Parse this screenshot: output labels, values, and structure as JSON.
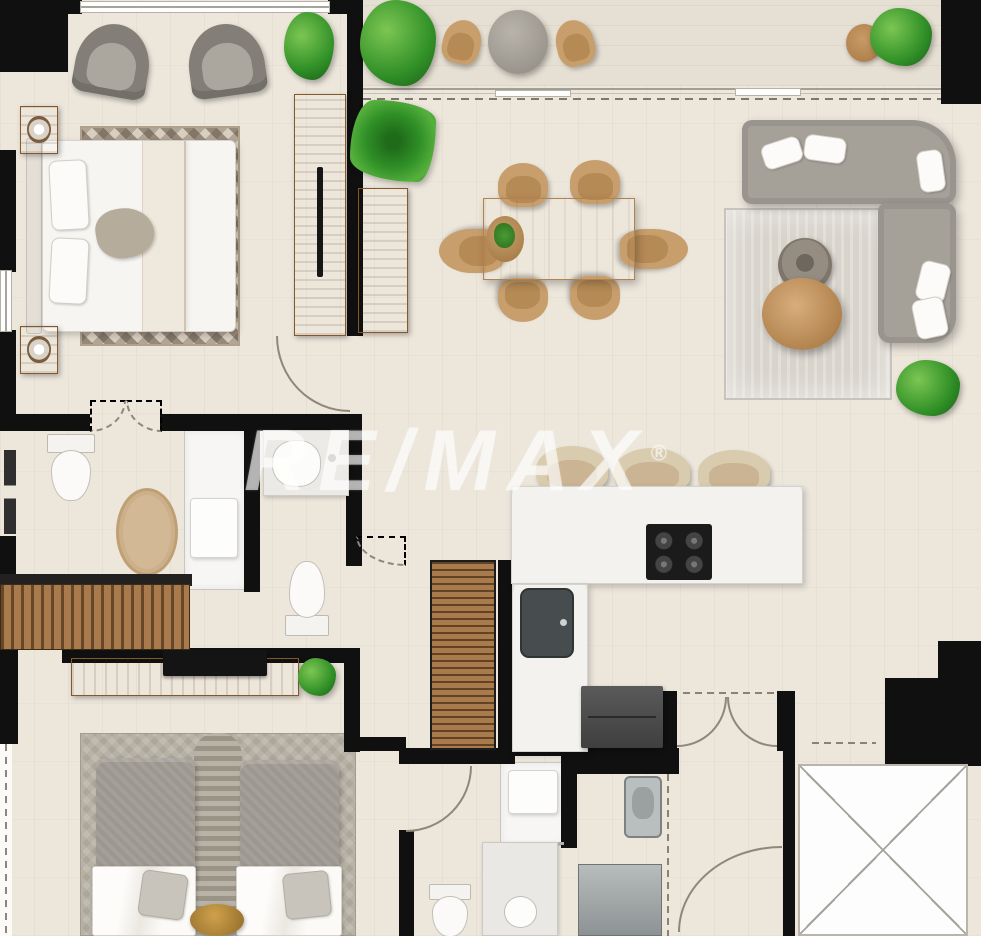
{
  "watermark": {
    "text": "RE/MAX",
    "registered": "®"
  },
  "colors": {
    "wall": "#101010",
    "floor": "#ece6db",
    "floor_balcony": "#e6dfd3",
    "wood": "#b5824f",
    "sofa": "#a5a199",
    "rug_living": "#d8d4cc",
    "rug_bed2": "#b7b1a4",
    "counter": "#f3f2ef",
    "plant": "#2f8f26",
    "gold": "#cfa14c"
  },
  "elements": [
    {
      "n": "floor-main",
      "t": "floor",
      "x": 0,
      "y": 0,
      "w": 981,
      "h": 936
    },
    {
      "n": "floor-balcony",
      "t": "floor-balcony",
      "x": 363,
      "y": 0,
      "w": 578,
      "h": 86
    },
    {
      "n": "shower-floor-master",
      "t": "shower-floor",
      "x": 184,
      "y": 430,
      "w": 62,
      "h": 160
    },
    {
      "n": "shower-floor-second",
      "t": "shower-floor",
      "x": 500,
      "y": 762,
      "w": 66,
      "h": 84
    },
    {
      "n": "rug-master-bedroom",
      "t": "rug-zigzag",
      "x": 80,
      "y": 126,
      "w": 160,
      "h": 220
    },
    {
      "n": "rug-living-room",
      "t": "rug-living",
      "x": 724,
      "y": 208,
      "w": 168,
      "h": 192
    },
    {
      "n": "rug-second-bedroom",
      "t": "rug-bed2",
      "x": 80,
      "y": 733,
      "w": 276,
      "h": 203
    },
    {
      "n": "rug-runner-second-bedroom",
      "t": "runner",
      "x": 194,
      "y": 733,
      "w": 48,
      "h": 203
    },
    {
      "n": "rug-oval-bathroom",
      "t": "rug-oval",
      "x": 116,
      "y": 488,
      "w": 62,
      "h": 88
    },
    {
      "n": "wall-corner-top-left",
      "t": "wall",
      "x": 0,
      "y": 0,
      "w": 68,
      "h": 72
    },
    {
      "n": "wall-top-a",
      "t": "wall",
      "x": 62,
      "y": 0,
      "w": 20,
      "h": 14
    },
    {
      "n": "wall-top-b",
      "t": "wall",
      "x": 328,
      "y": 0,
      "w": 35,
      "h": 14
    },
    {
      "n": "wall-bedroom-right",
      "t": "wall",
      "x": 347,
      "y": 0,
      "w": 16,
      "h": 336
    },
    {
      "n": "wall-corner-top-right",
      "t": "wall",
      "x": 941,
      "y": 0,
      "w": 40,
      "h": 104
    },
    {
      "n": "wall-left-upper",
      "t": "wall",
      "x": 0,
      "y": 150,
      "w": 16,
      "h": 122
    },
    {
      "n": "wall-left-mid",
      "t": "wall",
      "x": 0,
      "y": 330,
      "w": 16,
      "h": 88
    },
    {
      "n": "wall-bathroom-top-a",
      "t": "wall",
      "x": 0,
      "y": 414,
      "w": 90,
      "h": 17
    },
    {
      "n": "wall-bathroom-top-b",
      "t": "wall",
      "x": 160,
      "y": 414,
      "w": 202,
      "h": 17
    },
    {
      "n": "wall-mid-vertical",
      "t": "wall",
      "x": 346,
      "y": 414,
      "w": 16,
      "h": 152
    },
    {
      "n": "wall-bathroom-divider",
      "t": "wall",
      "x": 244,
      "y": 428,
      "w": 16,
      "h": 164
    },
    {
      "n": "wall-left-lower",
      "t": "wall",
      "x": 0,
      "y": 536,
      "w": 16,
      "h": 50
    },
    {
      "n": "wall-closet-frame",
      "t": "wall-dark",
      "x": 0,
      "y": 574,
      "w": 192,
      "h": 12
    },
    {
      "n": "wall-bedroom2-top",
      "t": "wall",
      "x": 62,
      "y": 648,
      "w": 296,
      "h": 15
    },
    {
      "n": "wall-hall-vertical",
      "t": "wall",
      "x": 344,
      "y": 648,
      "w": 16,
      "h": 104
    },
    {
      "n": "wall-bath2-top-a",
      "t": "wall",
      "x": 344,
      "y": 737,
      "w": 62,
      "h": 14
    },
    {
      "n": "wall-bath2-top-b",
      "t": "wall",
      "x": 399,
      "y": 748,
      "w": 116,
      "h": 16
    },
    {
      "n": "wall-bath2-left",
      "t": "wall",
      "x": 399,
      "y": 830,
      "w": 15,
      "h": 106
    },
    {
      "n": "wall-bath2-right",
      "t": "wall",
      "x": 561,
      "y": 746,
      "w": 16,
      "h": 102
    },
    {
      "n": "wall-pantry-right",
      "t": "wall",
      "x": 498,
      "y": 560,
      "w": 14,
      "h": 192
    },
    {
      "n": "wall-under-counter",
      "t": "wall",
      "x": 498,
      "y": 740,
      "w": 80,
      "h": 16
    },
    {
      "n": "wall-utility-top",
      "t": "wall",
      "x": 575,
      "y": 748,
      "w": 104,
      "h": 26
    },
    {
      "n": "wall-entry-left",
      "t": "wall",
      "x": 661,
      "y": 691,
      "w": 16,
      "h": 60
    },
    {
      "n": "wall-entry-right",
      "t": "wall",
      "x": 777,
      "y": 691,
      "w": 18,
      "h": 60
    },
    {
      "n": "wall-hallway-left",
      "t": "wall",
      "x": 783,
      "y": 691,
      "w": 12,
      "h": 245
    },
    {
      "n": "wall-elevator-block",
      "t": "wall",
      "x": 885,
      "y": 678,
      "w": 96,
      "h": 88
    },
    {
      "n": "wall-corner-right",
      "t": "wall",
      "x": 938,
      "y": 641,
      "w": 43,
      "h": 42
    },
    {
      "n": "wall-bedroom2-left",
      "t": "wall",
      "x": 0,
      "y": 648,
      "w": 18,
      "h": 96
    },
    {
      "n": "window-bedroom-top",
      "t": "window-h",
      "x": 80,
      "y": 1,
      "w": 250,
      "h": 12
    },
    {
      "n": "window-left-upper",
      "t": "window-v",
      "x": 0,
      "y": 270,
      "w": 12,
      "h": 62
    },
    {
      "n": "window-bedroom2-left",
      "t": "window-dashed",
      "x": 0,
      "y": 744,
      "w": 12,
      "h": 192
    },
    {
      "n": "balcony-door-track",
      "t": "window-track",
      "x": 363,
      "y": 86,
      "w": 578,
      "h": 18
    },
    {
      "n": "balcony-door-leaf-1",
      "t": "window-leaf",
      "x": 495,
      "y": 90,
      "w": 76,
      "h": 7
    },
    {
      "n": "balcony-door-leaf-2",
      "t": "window-leaf",
      "x": 735,
      "y": 88,
      "w": 66,
      "h": 8
    },
    {
      "n": "elevator-shaft",
      "t": "elevator",
      "x": 798,
      "y": 764,
      "w": 170,
      "h": 172
    },
    {
      "n": "bed-headboard-master",
      "t": "bed-head",
      "x": 26,
      "y": 138,
      "w": 16,
      "h": 196
    },
    {
      "n": "bed-master",
      "t": "bed-body",
      "x": 42,
      "y": 140,
      "w": 194,
      "h": 192
    },
    {
      "n": "pillow-master-1",
      "t": "pillow",
      "x": 50,
      "y": 160,
      "w": 38,
      "h": 70,
      "rot": -3
    },
    {
      "n": "pillow-master-2",
      "t": "pillow",
      "x": 50,
      "y": 238,
      "w": 38,
      "h": 66,
      "rot": 3
    },
    {
      "n": "bed-throw-band",
      "t": "throw",
      "x": 142,
      "y": 141,
      "w": 44,
      "h": 190
    },
    {
      "n": "pillow-master-accent",
      "t": "pillow-taupe",
      "x": 96,
      "y": 208,
      "w": 58,
      "h": 50,
      "rot": -10
    },
    {
      "n": "armchair-master-1",
      "t": "armchair",
      "x": 76,
      "y": 24,
      "w": 74,
      "h": 72,
      "rot": 10
    },
    {
      "n": "armchair-master-2",
      "t": "armchair",
      "x": 188,
      "y": 24,
      "w": 76,
      "h": 72,
      "rot": -8
    },
    {
      "n": "plant-bedroom-corner",
      "t": "plant",
      "x": 284,
      "y": 12,
      "w": 50,
      "h": 68
    },
    {
      "n": "nightstand-1",
      "t": "nightstand",
      "x": 20,
      "y": 106,
      "w": 38,
      "h": 48
    },
    {
      "n": "nightstand-2",
      "t": "nightstand",
      "x": 20,
      "y": 326,
      "w": 38,
      "h": 48
    },
    {
      "n": "wardrobe-master",
      "t": "wardrobe",
      "x": 294,
      "y": 94,
      "w": 52,
      "h": 242
    },
    {
      "n": "plant-balcony-large",
      "t": "plant",
      "x": 360,
      "y": 0,
      "w": 76,
      "h": 86
    },
    {
      "n": "plant-balcony-palm",
      "t": "plant-palm",
      "x": 350,
      "y": 100,
      "w": 86,
      "h": 82
    },
    {
      "n": "balcony-chair-1",
      "t": "chair-wicker",
      "x": 443,
      "y": 20,
      "w": 38,
      "h": 44,
      "rot": 14
    },
    {
      "n": "balcony-pouf",
      "t": "pouf",
      "x": 488,
      "y": 10,
      "w": 60,
      "h": 64
    },
    {
      "n": "balcony-chair-2",
      "t": "chair-wicker",
      "x": 556,
      "y": 20,
      "w": 38,
      "h": 46,
      "rot": -14
    },
    {
      "n": "balcony-stool-wicker",
      "t": "stool-wicker",
      "x": 846,
      "y": 24,
      "w": 36,
      "h": 38
    },
    {
      "n": "plant-balcony-right",
      "t": "plant",
      "x": 870,
      "y": 8,
      "w": 62,
      "h": 58
    },
    {
      "n": "dining-chair-1",
      "t": "chair-wicker",
      "x": 498,
      "y": 163,
      "w": 50,
      "h": 44
    },
    {
      "n": "dining-chair-2",
      "t": "chair-wicker",
      "x": 570,
      "y": 160,
      "w": 50,
      "h": 44
    },
    {
      "n": "dining-chair-3",
      "t": "chair-wicker",
      "x": 450,
      "y": 218,
      "w": 44,
      "h": 66,
      "rot": -90
    },
    {
      "n": "dining-chair-4",
      "t": "chair-wicker",
      "x": 634,
      "y": 215,
      "w": 40,
      "h": 68,
      "rot": 90
    },
    {
      "n": "dining-chair-5",
      "t": "chair-wicker",
      "x": 498,
      "y": 278,
      "w": 50,
      "h": 44,
      "rot": 180
    },
    {
      "n": "dining-chair-6",
      "t": "chair-wicker",
      "x": 570,
      "y": 276,
      "w": 50,
      "h": 44,
      "rot": 180
    },
    {
      "n": "dining-table",
      "t": "table-wood",
      "x": 483,
      "y": 198,
      "w": 152,
      "h": 82
    },
    {
      "n": "dining-centerpiece",
      "t": "centerpiece",
      "x": 486,
      "y": 216,
      "w": 38,
      "h": 46
    },
    {
      "n": "sideboard-dining",
      "t": "wood-panel",
      "x": 358,
      "y": 188,
      "w": 50,
      "h": 145
    },
    {
      "n": "sofa-sectional-top",
      "t": "sofa sofa-top",
      "x": 742,
      "y": 120,
      "w": 214,
      "h": 84
    },
    {
      "n": "sofa-sectional-right",
      "t": "sofa sofa-right",
      "x": 878,
      "y": 203,
      "w": 78,
      "h": 140
    },
    {
      "n": "sofa-pillow-1",
      "t": "pillow",
      "x": 762,
      "y": 140,
      "w": 40,
      "h": 26,
      "rot": -18
    },
    {
      "n": "sofa-pillow-2",
      "t": "pillow",
      "x": 804,
      "y": 136,
      "w": 42,
      "h": 26,
      "rot": 8
    },
    {
      "n": "sofa-pillow-3",
      "t": "pillow",
      "x": 918,
      "y": 150,
      "w": 26,
      "h": 42,
      "rot": -8
    },
    {
      "n": "sofa-pillow-4",
      "t": "pillow",
      "x": 918,
      "y": 262,
      "w": 30,
      "h": 40,
      "rot": 14
    },
    {
      "n": "sofa-pillow-5",
      "t": "pillow",
      "x": 914,
      "y": 298,
      "w": 32,
      "h": 40,
      "rot": -12
    },
    {
      "n": "coffee-table-tray",
      "t": "tray-table",
      "x": 778,
      "y": 238,
      "w": 54,
      "h": 54
    },
    {
      "n": "floor-vase",
      "t": "jug",
      "x": 762,
      "y": 278,
      "w": 80,
      "h": 72
    },
    {
      "n": "plant-living-room",
      "t": "plant",
      "x": 896,
      "y": 360,
      "w": 64,
      "h": 56
    },
    {
      "n": "bar-stool-1",
      "t": "chair-wicker stool-bar",
      "x": 536,
      "y": 446,
      "w": 72,
      "h": 46
    },
    {
      "n": "bar-stool-2",
      "t": "chair-wicker stool-bar",
      "x": 614,
      "y": 448,
      "w": 76,
      "h": 46
    },
    {
      "n": "bar-stool-3",
      "t": "chair-wicker stool-bar",
      "x": 698,
      "y": 450,
      "w": 72,
      "h": 44
    },
    {
      "n": "kitchen-counter",
      "t": "counter",
      "x": 511,
      "y": 486,
      "w": 292,
      "h": 98
    },
    {
      "n": "kitchen-counter-leg",
      "t": "counter",
      "x": 512,
      "y": 584,
      "w": 76,
      "h": 168
    },
    {
      "n": "stove",
      "t": "stove",
      "x": 646,
      "y": 524,
      "w": 66,
      "h": 56
    },
    {
      "n": "kitchen-sink",
      "t": "sink-steel",
      "x": 520,
      "y": 588,
      "w": 54,
      "h": 70
    },
    {
      "n": "pantry-louver",
      "t": "louver",
      "x": 430,
      "y": 560,
      "w": 66,
      "h": 190
    },
    {
      "n": "refrigerator",
      "t": "fridge",
      "x": 581,
      "y": 686,
      "w": 82,
      "h": 62
    },
    {
      "n": "toilet-master",
      "t": "toilet",
      "x": 44,
      "y": 434,
      "w": 52,
      "h": 66
    },
    {
      "n": "shower-glass-master",
      "t": "glass-bars",
      "x": 4,
      "y": 450,
      "w": 12,
      "h": 84
    },
    {
      "n": "shower-seat-master",
      "t": "shower-seat",
      "x": 190,
      "y": 498,
      "w": 48,
      "h": 60
    },
    {
      "n": "corner-sink-wc",
      "t": "sink-corner",
      "x": 263,
      "y": 430,
      "w": 86,
      "h": 66
    },
    {
      "n": "toilet-wc",
      "t": "toilet",
      "x": 284,
      "y": 562,
      "w": 48,
      "h": 74,
      "rot": 180
    },
    {
      "n": "closet-louver-doors",
      "t": "closet-louver",
      "x": 0,
      "y": 584,
      "w": 190,
      "h": 66
    },
    {
      "n": "tv-console",
      "t": "console-wood",
      "x": 71,
      "y": 658,
      "w": 228,
      "h": 38
    },
    {
      "n": "tv",
      "t": "tv",
      "x": 163,
      "y": 650,
      "w": 104,
      "h": 26
    },
    {
      "n": "plant-console",
      "t": "plant",
      "x": 298,
      "y": 658,
      "w": 38,
      "h": 38
    },
    {
      "n": "bed2-left-top",
      "t": "bed2-top",
      "x": 96,
      "y": 758,
      "w": 99,
      "h": 122
    },
    {
      "n": "bed2-left-linen",
      "t": "bed2-linen",
      "x": 92,
      "y": 866,
      "w": 104,
      "h": 70
    },
    {
      "n": "bed2-right-top",
      "t": "bed2-top",
      "x": 240,
      "y": 760,
      "w": 99,
      "h": 120
    },
    {
      "n": "bed2-right-linen",
      "t": "bed2-linen",
      "x": 236,
      "y": 866,
      "w": 106,
      "h": 70
    },
    {
      "n": "pillow-bed2-left",
      "t": "pillow-gray",
      "x": 140,
      "y": 872,
      "w": 46,
      "h": 46,
      "rot": 8
    },
    {
      "n": "pillow-bed2-right",
      "t": "pillow-gray",
      "x": 284,
      "y": 872,
      "w": 46,
      "h": 46,
      "rot": -6
    },
    {
      "n": "stool-gold",
      "t": "stool-gold",
      "x": 190,
      "y": 904,
      "w": 54,
      "h": 32
    },
    {
      "n": "shower-seat-second",
      "t": "shower-seat",
      "x": 508,
      "y": 770,
      "w": 50,
      "h": 44
    },
    {
      "n": "shower-glass-second",
      "t": "glass-line",
      "x": 502,
      "y": 842,
      "w": 62,
      "h": 3
    },
    {
      "n": "vanity-second",
      "t": "vanity",
      "x": 482,
      "y": 842,
      "w": 76,
      "h": 94
    },
    {
      "n": "toilet-second",
      "t": "toilet",
      "x": 426,
      "y": 884,
      "w": 46,
      "h": 52
    },
    {
      "n": "laundry-sink",
      "t": "sink-small",
      "x": 624,
      "y": 776,
      "w": 38,
      "h": 62
    },
    {
      "n": "washer",
      "t": "washer",
      "x": 578,
      "y": 864,
      "w": 84,
      "h": 72
    },
    {
      "n": "door-master-bedroom",
      "t": "arc arc-bl",
      "x": 276,
      "y": 336,
      "w": 74,
      "h": 76
    },
    {
      "n": "door-bathroom-dashed-1",
      "t": "arc arc-br dashed",
      "x": 90,
      "y": 400,
      "w": 36,
      "h": 32
    },
    {
      "n": "door-bathroom-dashed-2",
      "t": "arc arc-bl dashed",
      "x": 126,
      "y": 400,
      "w": 36,
      "h": 32
    },
    {
      "n": "door-wc-dashed",
      "t": "arc arc-bl dashed",
      "x": 356,
      "y": 536,
      "w": 50,
      "h": 30
    },
    {
      "n": "entry-door-left",
      "t": "arc arc-br",
      "x": 677,
      "y": 697,
      "w": 50,
      "h": 50
    },
    {
      "n": "entry-door-right",
      "t": "arc arc-bl",
      "x": 727,
      "y": 697,
      "w": 50,
      "h": 50
    },
    {
      "n": "entry-threshold-dashed",
      "t": "dash-h",
      "x": 683,
      "y": 690,
      "w": 96,
      "h": 5
    },
    {
      "n": "door-bath2",
      "t": "arc arc-br",
      "x": 406,
      "y": 766,
      "w": 66,
      "h": 66
    },
    {
      "n": "door-hallway",
      "t": "arc arc-tl",
      "x": 678,
      "y": 846,
      "w": 104,
      "h": 86
    },
    {
      "n": "lobby-dashed",
      "t": "dash-h",
      "x": 812,
      "y": 740,
      "w": 64,
      "h": 6
    },
    {
      "n": "laundry-slider-dashed",
      "t": "dash-v",
      "x": 666,
      "y": 774,
      "w": 4,
      "h": 162
    }
  ]
}
